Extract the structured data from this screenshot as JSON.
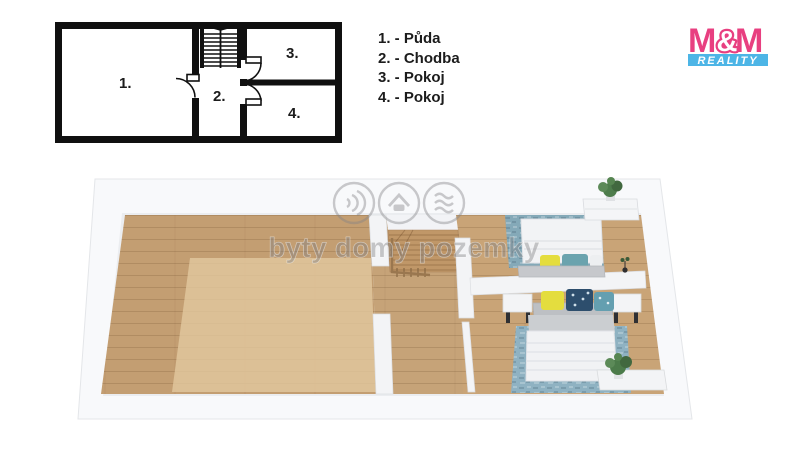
{
  "legend": {
    "items": [
      {
        "label": "1. - Půda"
      },
      {
        "label": "2. - Chodba"
      },
      {
        "label": "3. - Pokoj"
      },
      {
        "label": "4. - Pokoj"
      }
    ]
  },
  "plan2d": {
    "room_labels": [
      {
        "label": "1."
      },
      {
        "label": "2."
      },
      {
        "label": "3."
      },
      {
        "label": "4."
      }
    ],
    "line_color": "#101010"
  },
  "logo": {
    "m_left": "M",
    "ampersand": "&",
    "m_right": "M",
    "subtitle": "REALITY",
    "colors": {
      "magenta": "#e83f80",
      "cyan": "#4db5e6"
    }
  },
  "watermark": {
    "text": "byty domy pozemky",
    "icons": [
      "sound-waves-icon",
      "house-icon",
      "layers-icon"
    ],
    "color": "#8f9193"
  },
  "plan3d": {
    "colors": {
      "wall": "#f3f4f6",
      "floor_wood": "#c39e72",
      "floor_wood_light": "#e2c89f",
      "rug_blue": "#8fb2c2",
      "bedding_white": "#f2f3f5",
      "pillow_yellow": "#e4dd3e",
      "pillow_navy": "#2d4e6d",
      "pillow_teal": "#6aa3ae",
      "plant_green": "#4c7b4a"
    }
  }
}
